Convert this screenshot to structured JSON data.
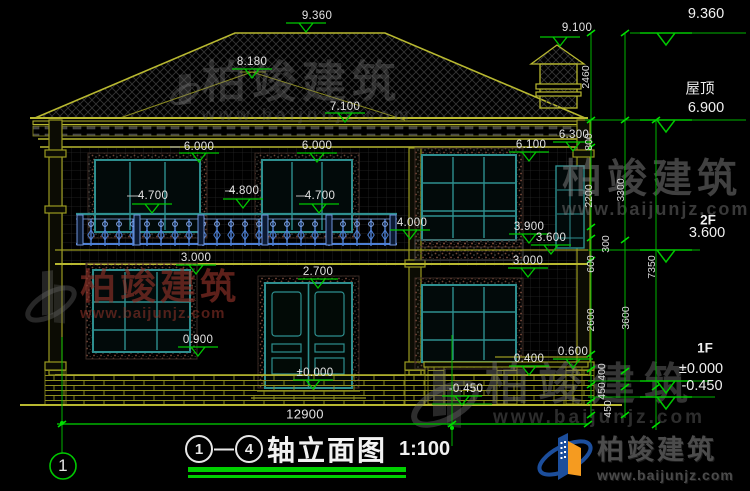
{
  "titlebar": {
    "axis_start": "1",
    "axis_end": "4",
    "dash": "—",
    "title": "轴立面图",
    "scale": "1:100"
  },
  "axis": {
    "left_bubble": "1"
  },
  "right_panel": {
    "top_elev": "9.360",
    "roof_name": "屋顶",
    "roof_elev": "6.900",
    "f2_name": "2F",
    "f2_elev": "3.600",
    "f1_name": "1F",
    "f1_elev": "±0.000",
    "f1_neg": "-0.450"
  },
  "marks": {
    "m9360": "9.360",
    "m9100": "9.100",
    "m8180": "8.180",
    "m7100": "7.100",
    "m6300": "6.300",
    "m6100": "6.100",
    "m6000a": "6.000",
    "m6000b": "6.000",
    "m4700a": "4.700",
    "m4800": "4.800",
    "m4700b": "4.700",
    "m4000": "4.000",
    "m3900": "3.900",
    "m3600": "3.600",
    "m3000a": "3.000",
    "m3000b": "3.000",
    "m2700": "2.700",
    "m0900": "0.900",
    "m0600": "0.600",
    "m0400": "0.400",
    "m0000": "±0.000",
    "mn0450": "-0.450"
  },
  "dims": {
    "w12900": "12900",
    "v2460": "2460",
    "v800": "800",
    "v2200": "2200",
    "v3300": "3300",
    "v300": "300",
    "v600": "600",
    "v2600": "2600",
    "v3600": "3600",
    "v400": "400",
    "v450a": "450",
    "v450b": "450",
    "v7350": "7350"
  },
  "watermark": {
    "brand": "柏竣建筑",
    "url": "www.baijunjz.com"
  },
  "logo": {
    "brand": "柏竣建筑",
    "url": "www.baijunjz.com"
  },
  "colors": {
    "dim_green": "#00c800",
    "line_yellow": "#9a9a20",
    "frame_teal": "#2e8f8f",
    "railing_blue": "#4d7fd4",
    "logo_blue": "#1c4e9c",
    "logo_orange": "#f59b20",
    "underline_green": "#00cf00"
  }
}
